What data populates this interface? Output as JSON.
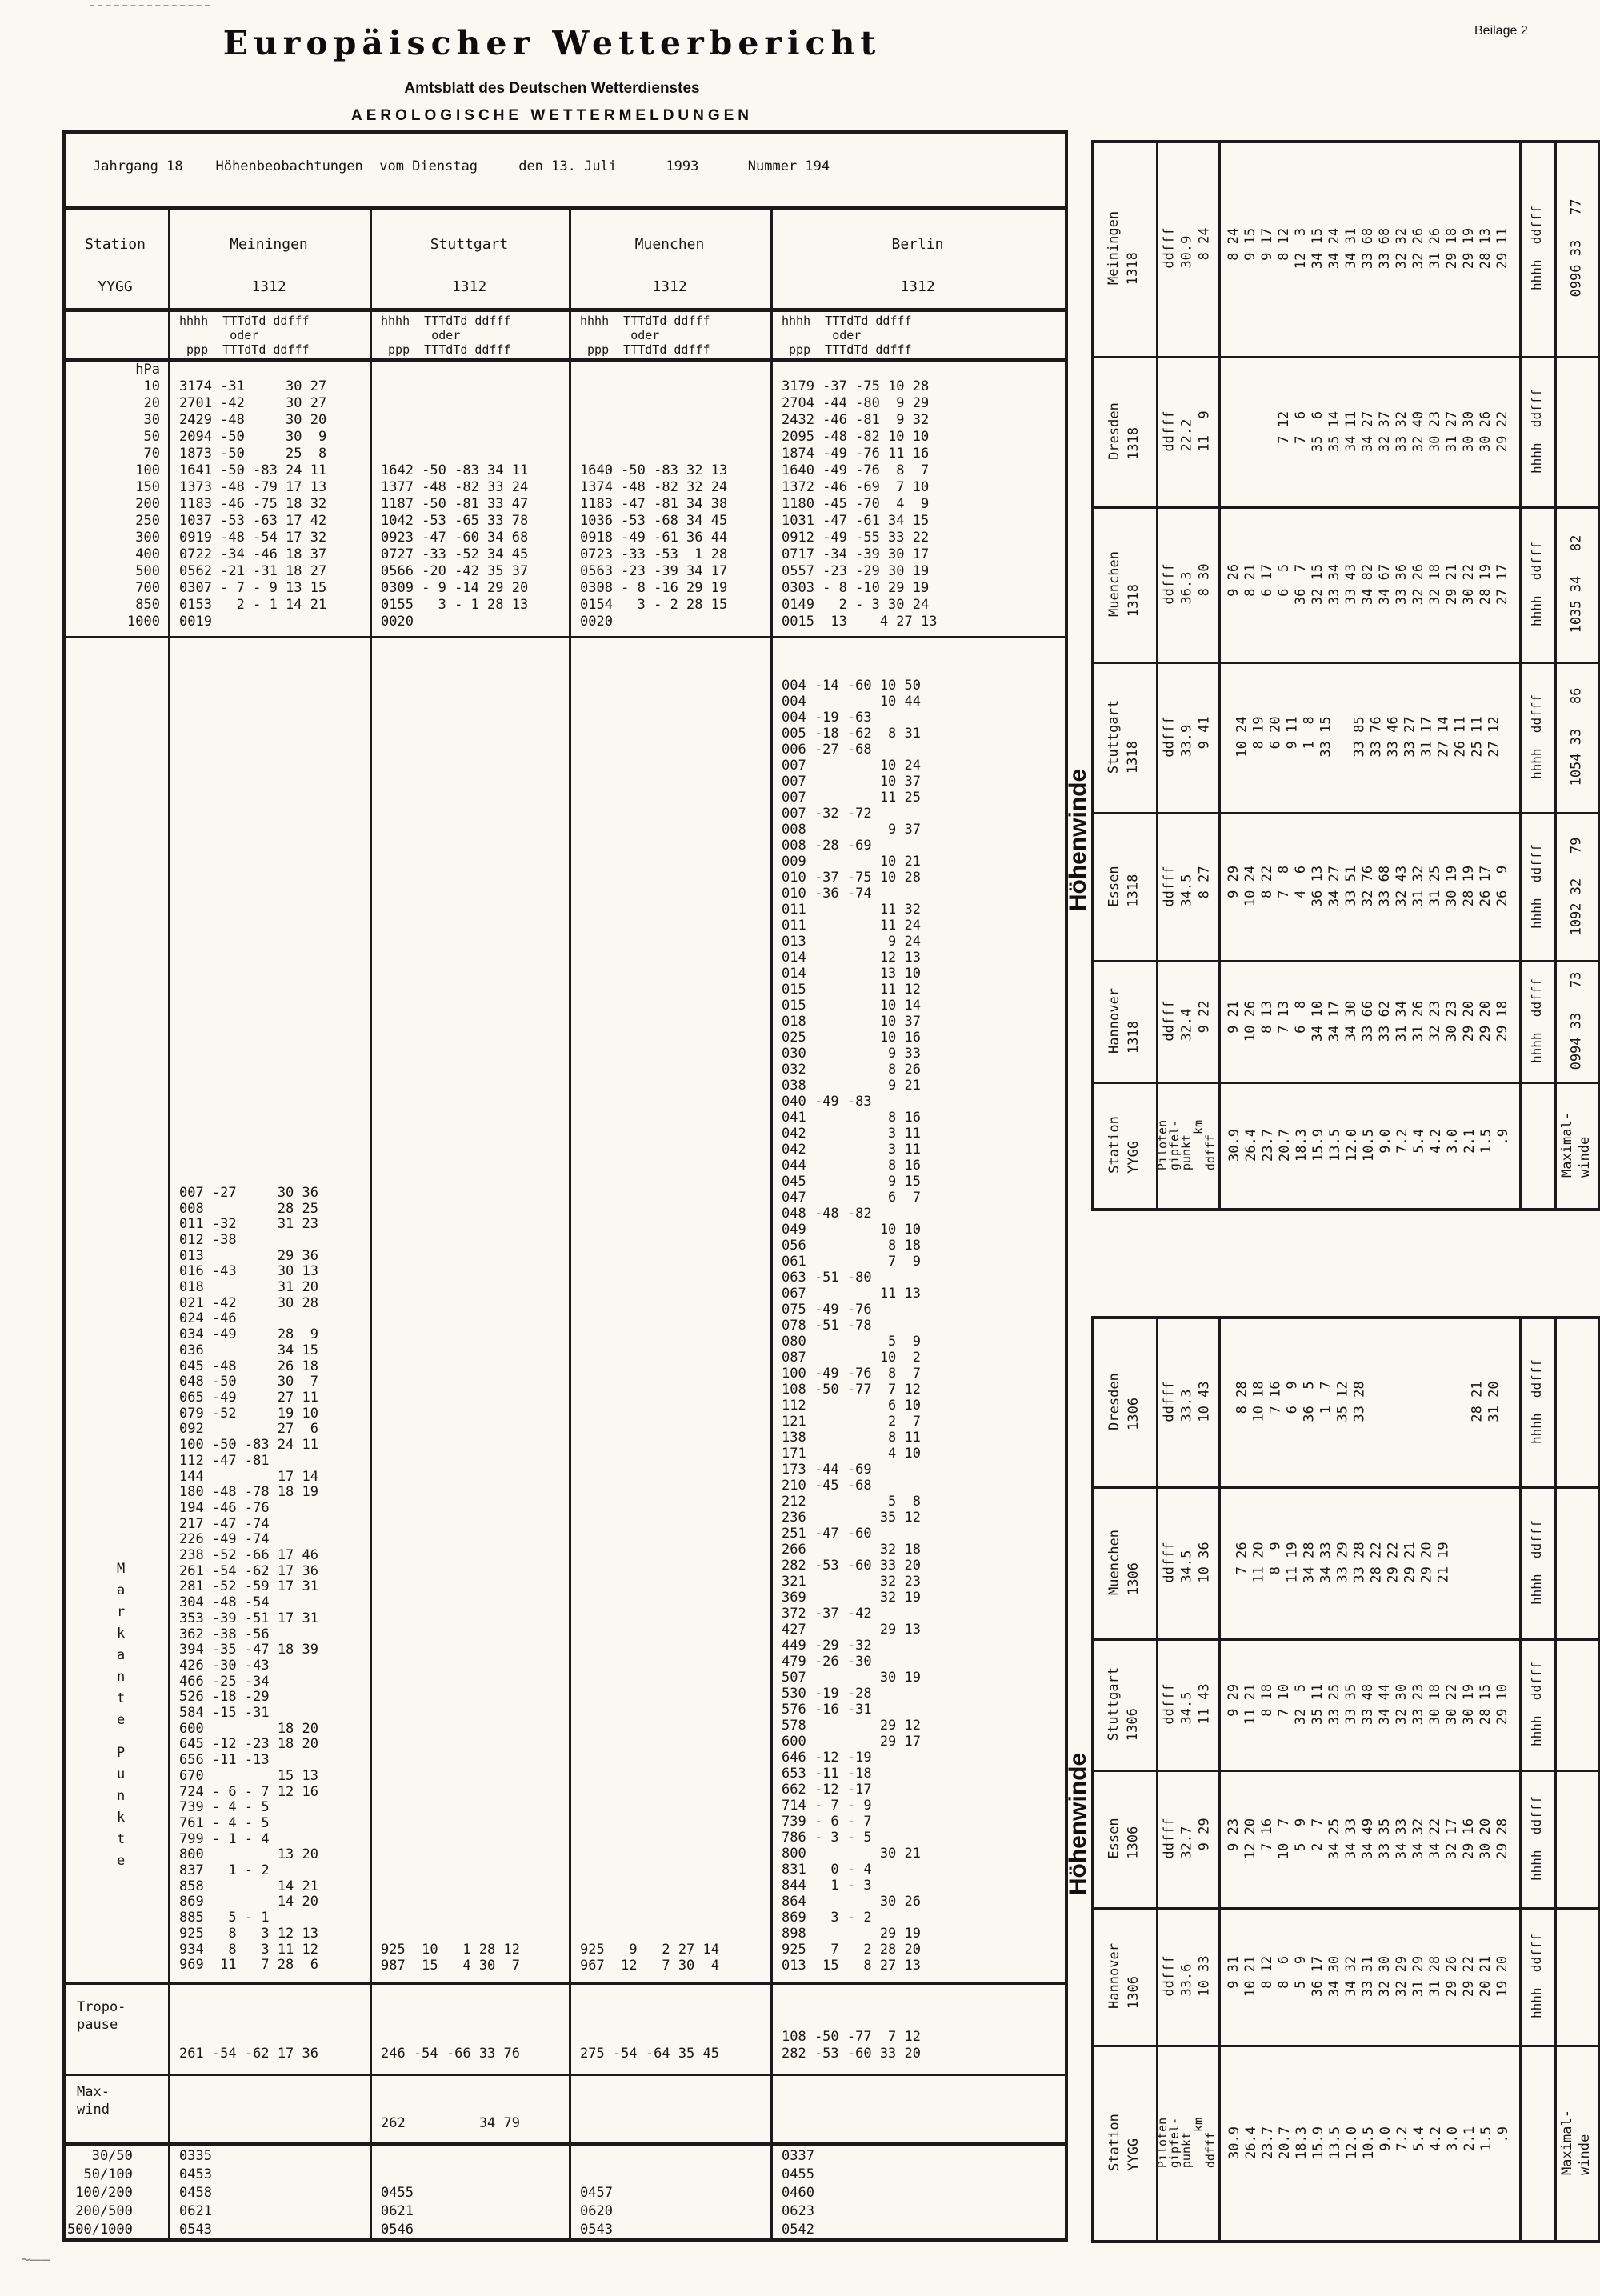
{
  "colors": {
    "paper": "#faf8f3",
    "ink": "#1b1b1b",
    "text": "#161616"
  },
  "page": {
    "beilage": "Beilage 2",
    "corner_mark": "~——"
  },
  "header": {
    "title": "Europäischer Wetterbericht",
    "subtitle": "Amtsblatt des Deutschen Wetterdienstes",
    "section": "AEROLOGISCHE WETTERMELDUNGEN",
    "meta": "Jahrgang 18    Höhenbeobachtungen  vom Dienstag     den 13. Juli      1993      Nummer 194"
  },
  "left_table": {
    "station_header": {
      "label": "Station",
      "yygg": "YYGG"
    },
    "subheader": [
      "hhhh  TTTdTd ddfff",
      "       oder",
      " ppp  TTTdTd ddfff"
    ],
    "hpa_labels": [
      " hPa",
      "  10",
      "  20",
      "  30",
      "  50",
      "  70",
      " 100",
      " 150",
      " 200",
      " 250",
      " 300",
      " 400",
      " 500",
      " 700",
      " 850",
      "1000"
    ],
    "markante": [
      "M",
      "a",
      "r",
      "k",
      "a",
      "n",
      "t",
      "e"
    ],
    "punkte": [
      "P",
      "u",
      "n",
      "k",
      "t",
      "e"
    ],
    "tropo_label": [
      "Tropo-",
      "pause"
    ],
    "maxwind_label": [
      "Max-",
      "wind"
    ],
    "layer_labels": [
      "   30/50",
      "  50/100",
      " 100/200",
      " 200/500",
      "500/1000"
    ],
    "columns": [
      {
        "name": "Meiningen",
        "time": "1312",
        "pressure": [
          "3174 -31     30 27",
          "2701 -42     30 27",
          "2429 -48     30 20",
          "2094 -50     30  9",
          "1873 -50     25  8",
          "1641 -50 -83 24 11",
          "1373 -48 -79 17 13",
          "1183 -46 -75 18 32",
          "1037 -53 -63 17 42",
          "0919 -48 -54 17 32",
          "0722 -34 -46 18 37",
          "0562 -21 -31 18 27",
          "0307 - 7 - 9 13 15",
          "0153   2 - 1 14 21",
          "0019"
        ],
        "points": [
          "007 -27     30 36",
          "008         28 25",
          "011 -32     31 23",
          "012 -38",
          "013         29 36",
          "016 -43     30 13",
          "018         31 20",
          "021 -42     30 28",
          "024 -46",
          "034 -49     28  9",
          "036         34 15",
          "045 -48     26 18",
          "048 -50     30  7",
          "065 -49     27 11",
          "079 -52     19 10",
          "092         27  6",
          "100 -50 -83 24 11",
          "112 -47 -81",
          "144         17 14",
          "180 -48 -78 18 19",
          "194 -46 -76",
          "217 -47 -74",
          "226 -49 -74",
          "238 -52 -66 17 46",
          "261 -54 -62 17 36",
          "281 -52 -59 17 31",
          "304 -48 -54",
          "353 -39 -51 17 31",
          "362 -38 -56",
          "394 -35 -47 18 39",
          "426 -30 -43",
          "466 -25 -34",
          "526 -18 -29",
          "584 -15 -31",
          "600         18 20",
          "645 -12 -23 18 20",
          "656 -11 -13",
          "670         15 13",
          "724 - 6 - 7 12 16",
          "739 - 4 - 5",
          "761 - 4 - 5",
          "799 - 1 - 4",
          "800         13 20",
          "837   1 - 2",
          "858         14 21",
          "869         14 20",
          "885   5 - 1",
          "925   8   3 12 13",
          "934   8   3 11 12",
          "969  11   7 28  6"
        ],
        "tropopause": [
          "261 -54 -62 17 36"
        ],
        "maxwind": [],
        "layers": [
          "0335",
          "0453",
          "0458",
          "0621",
          "0543"
        ]
      },
      {
        "name": "Stuttgart",
        "time": "1312",
        "pressure": [
          "",
          "",
          "",
          "",
          "",
          "1642 -50 -83 34 11",
          "1377 -48 -82 33 24",
          "1187 -50 -81 33 47",
          "1042 -53 -65 33 78",
          "0923 -47 -60 34 68",
          "0727 -33 -52 34 45",
          "0566 -20 -42 35 37",
          "0309 - 9 -14 29 20",
          "0155   3 - 1 28 13",
          "0020"
        ],
        "points": [
          "925  10   1 28 12",
          "987  15   4 30  7"
        ],
        "tropopause": [
          "246 -54 -66 33 76"
        ],
        "maxwind": [
          "262         34 79"
        ],
        "layers": [
          "",
          "",
          "0455",
          "0621",
          "0546"
        ]
      },
      {
        "name": "Muenchen",
        "time": "1312",
        "pressure": [
          "",
          "",
          "",
          "",
          "",
          "1640 -50 -83 32 13",
          "1374 -48 -82 32 24",
          "1183 -47 -81 34 38",
          "1036 -53 -68 34 45",
          "0918 -49 -61 36 44",
          "0723 -33 -53  1 28",
          "0563 -23 -39 34 17",
          "0308 - 8 -16 29 19",
          "0154   3 - 2 28 15",
          "0020"
        ],
        "points": [
          "925   9   2 27 14",
          "967  12   7 30  4"
        ],
        "tropopause": [
          "275 -54 -64 35 45"
        ],
        "maxwind": [],
        "layers": [
          "",
          "",
          "0457",
          "0620",
          "0543"
        ]
      },
      {
        "name": "Berlin",
        "time": "1312",
        "pressure": [
          "3179 -37 -75 10 28",
          "2704 -44 -80  9 29",
          "2432 -46 -81  9 32",
          "2095 -48 -82 10 10",
          "1874 -49 -76 11 16",
          "1640 -49 -76  8  7",
          "1372 -46 -69  7 10",
          "1180 -45 -70  4  9",
          "1031 -47 -61 34 15",
          "0912 -49 -55 33 22",
          "0717 -34 -39 30 17",
          "0557 -23 -29 30 19",
          "0303 - 8 -10 29 19",
          "0149   2 - 3 30 24",
          "0015  13    4 27 13"
        ],
        "points": [
          "004 -14 -60 10 50",
          "004         10 44",
          "004 -19 -63",
          "005 -18 -62  8 31",
          "006 -27 -68",
          "007         10 24",
          "007         10 37",
          "007         11 25",
          "007 -32 -72",
          "008          9 37",
          "008 -28 -69",
          "009         10 21",
          "010 -37 -75 10 28",
          "010 -36 -74",
          "011         11 32",
          "011         11 24",
          "013          9 24",
          "014         12 13",
          "014         13 10",
          "015         11 12",
          "015         10 14",
          "018         10 37",
          "025         10 16",
          "030          9 33",
          "032          8 26",
          "038          9 21",
          "040 -49 -83",
          "041          8 16",
          "042          3 11",
          "042          3 11",
          "044          8 16",
          "045          9 15",
          "047          6  7",
          "048 -48 -82",
          "049         10 10",
          "056          8 18",
          "061          7  9",
          "063 -51 -80",
          "067         11 13",
          "075 -49 -76",
          "078 -51 -78",
          "080          5  9",
          "087         10  2",
          "100 -49 -76  8  7",
          "108 -50 -77  7 12",
          "112          6 10",
          "121          2  7",
          "138          8 11",
          "171          4 10",
          "173 -44 -69",
          "210 -45 -68",
          "212          5  8",
          "236         35 12",
          "251 -47 -60",
          "266         32 18",
          "282 -53 -60 33 20",
          "321         32 23",
          "369         32 19",
          "372 -37 -42",
          "427         29 13",
          "449 -29 -32",
          "479 -26 -30",
          "507         30 19",
          "530 -19 -28",
          "576 -16 -31",
          "578         29 12",
          "600         29 17",
          "646 -12 -19",
          "653 -11 -18",
          "662 -12 -17",
          "714 - 7 - 9",
          "739 - 6 - 7",
          "786 - 3 - 5",
          "800         30 21",
          "831   0 - 4",
          "844   1 - 3",
          "864         30 26",
          "869   3 - 2",
          "898         29 19",
          "925   7   2 28 20",
          "013  15   8 27 13"
        ],
        "tropopause": [
          "108 -50 -77  7 12",
          "282 -53 -60 33 20"
        ],
        "maxwind": [],
        "layers": [
          "0337",
          "0455",
          "0460",
          "0623",
          "0542"
        ]
      }
    ]
  },
  "right": {
    "hoehenwinde_label": "Höhenwinde",
    "tail_label": "hhhh  ddfff",
    "legend": {
      "station": [
        "Station",
        "YYGG"
      ],
      "piloten": [
        "Piloten",
        "gipfel-",
        "punkt",
        "     km",
        "ddfff"
      ],
      "heights": [
        "30.9",
        "26.4",
        "23.7",
        "20.7",
        "18.3",
        "15.9",
        "13.5",
        "12.0",
        "10.5",
        " 9.0",
        " 7.2",
        " 5.4",
        " 4.2",
        " 3.0",
        " 2.1",
        " 1.5",
        "  .9"
      ],
      "maximal": [
        "Maximal-",
        "winde"
      ]
    },
    "panels": [
      {
        "rows": [
          {
            "station": "Meiningen",
            "time": "1318",
            "ddfff": [
              "ddfff",
              "30.9",
              " 8 24"
            ],
            "pairs": [
              " 8 24",
              " 9 15",
              " 9 17",
              " 8 12",
              "12  3",
              "34 15",
              "34 24",
              "34 31",
              "33 68",
              "33 68",
              "32 32",
              "32 26",
              "31 26",
              "29 18",
              "29 19",
              "28 13",
              "29 11"
            ],
            "max": "0996 33   77"
          },
          {
            "station": "Dresden",
            "time": "1318",
            "ddfff": [
              "ddfff",
              "22.2",
              "11  9"
            ],
            "pairs": [
              "",
              "",
              "",
              " 7 12",
              " 7  6",
              "35  6",
              "35 14",
              "34 11",
              "34 27",
              "32 37",
              "33 32",
              "32 40",
              "30 23",
              "31 27",
              "30 30",
              "30 26",
              "29 22"
            ],
            "max": ""
          },
          {
            "station": "Muenchen",
            "time": "1318",
            "ddfff": [
              "ddfff",
              "36.3",
              " 8 30"
            ],
            "pairs": [
              " 9 26",
              " 8 21",
              " 6 17",
              " 6  5",
              "36  7",
              "32 15",
              "33 34",
              "33 43",
              "34 82",
              "34 67",
              "33 36",
              "32 26",
              "32 18",
              "29 21",
              "30 22",
              "28 19",
              "27 17"
            ],
            "max": "1035 34   82"
          },
          {
            "station": "Stuttgart",
            "time": "1318",
            "ddfff": [
              "ddfff",
              "33.9",
              " 9 41"
            ],
            "pairs": [
              "10 24",
              " 8 19",
              " 6 20",
              " 9 11",
              " 1  8",
              "33 15",
              "",
              "33 85",
              "33 76",
              "33 46",
              "33 27",
              "31 17",
              "27 14",
              "26 11",
              "25 11",
              "27 12",
              ""
            ],
            "max": "1054 33   86"
          },
          {
            "station": "Essen",
            "time": "1318",
            "ddfff": [
              "ddfff",
              "34.5",
              " 8 27"
            ],
            "pairs": [
              " 9 29",
              "10 24",
              " 8 22",
              " 7  8",
              " 4  6",
              "36 13",
              "34 27",
              "33 51",
              "32 76",
              "33 68",
              "32 43",
              "31 32",
              "31 25",
              "30 19",
              "28 19",
              "26 17",
              "26  9"
            ],
            "max": "1092 32   79"
          },
          {
            "station": "Hannover",
            "time": "1318",
            "ddfff": [
              "ddfff",
              "32.4",
              " 9 22"
            ],
            "pairs": [
              " 9 21",
              "10 26",
              " 8 13",
              " 7 13",
              " 6  8",
              "34 10",
              "34 17",
              "34 30",
              "33 66",
              "33 62",
              "31 34",
              "31 26",
              "32 23",
              "30 23",
              "29 20",
              "29 20",
              "29 18"
            ],
            "max": "0994 33   73"
          }
        ]
      },
      {
        "rows": [
          {
            "station": "Dresden",
            "time": "1306",
            "ddfff": [
              "ddfff",
              "33.3",
              "10 43"
            ],
            "pairs": [
              " 8 28",
              "10 18",
              " 7 16",
              " 6  9",
              "36  5",
              " 1  7",
              "35 12",
              "33 28",
              "",
              "",
              "",
              "",
              "",
              "",
              "28 21",
              "31 20",
              ""
            ],
            "max": ""
          },
          {
            "station": "Muenchen",
            "time": "1306",
            "ddfff": [
              "ddfff",
              "34.5",
              "10 36"
            ],
            "pairs": [
              " 7 26",
              "11 20",
              " 8  9",
              "11 19",
              "34 28",
              "34 33",
              "33 29",
              "33 28",
              "28 22",
              "29 22",
              "29 21",
              "29 20",
              "21 19",
              "",
              "",
              "",
              ""
            ],
            "max": ""
          },
          {
            "station": "Stuttgart",
            "time": "1306",
            "ddfff": [
              "ddfff",
              "34.5",
              "11 43"
            ],
            "pairs": [
              " 9 29",
              "11 21",
              " 8 18",
              " 7 10",
              "32  5",
              "35 11",
              "33 25",
              "33 35",
              "33 48",
              "34 44",
              "32 30",
              "33 23",
              "30 18",
              "30 22",
              "30 19",
              "28 15",
              "29 10"
            ],
            "max": ""
          },
          {
            "station": "Essen",
            "time": "1306",
            "ddfff": [
              "ddfff",
              "32.7",
              " 9 29"
            ],
            "pairs": [
              " 9 23",
              "12 20",
              " 7 16",
              "10  7",
              " 5  9",
              " 2  7",
              "34 25",
              "34 33",
              "34 49",
              "33 35",
              "34 33",
              "34 32",
              "34 22",
              "32 17",
              "29 16",
              "30 20",
              "29 28"
            ],
            "max": ""
          },
          {
            "station": "Hannover",
            "time": "1306",
            "ddfff": [
              "ddfff",
              "33.6",
              "10 33"
            ],
            "pairs": [
              " 9 31",
              "10 21",
              " 8 12",
              " 8  6",
              " 5  9",
              "36 17",
              "34 30",
              "34 32",
              "33 31",
              "32 30",
              "32 29",
              "31 29",
              "31 28",
              "29 26",
              "29 22",
              "20 21",
              "19 20"
            ],
            "max": ""
          }
        ]
      }
    ]
  }
}
